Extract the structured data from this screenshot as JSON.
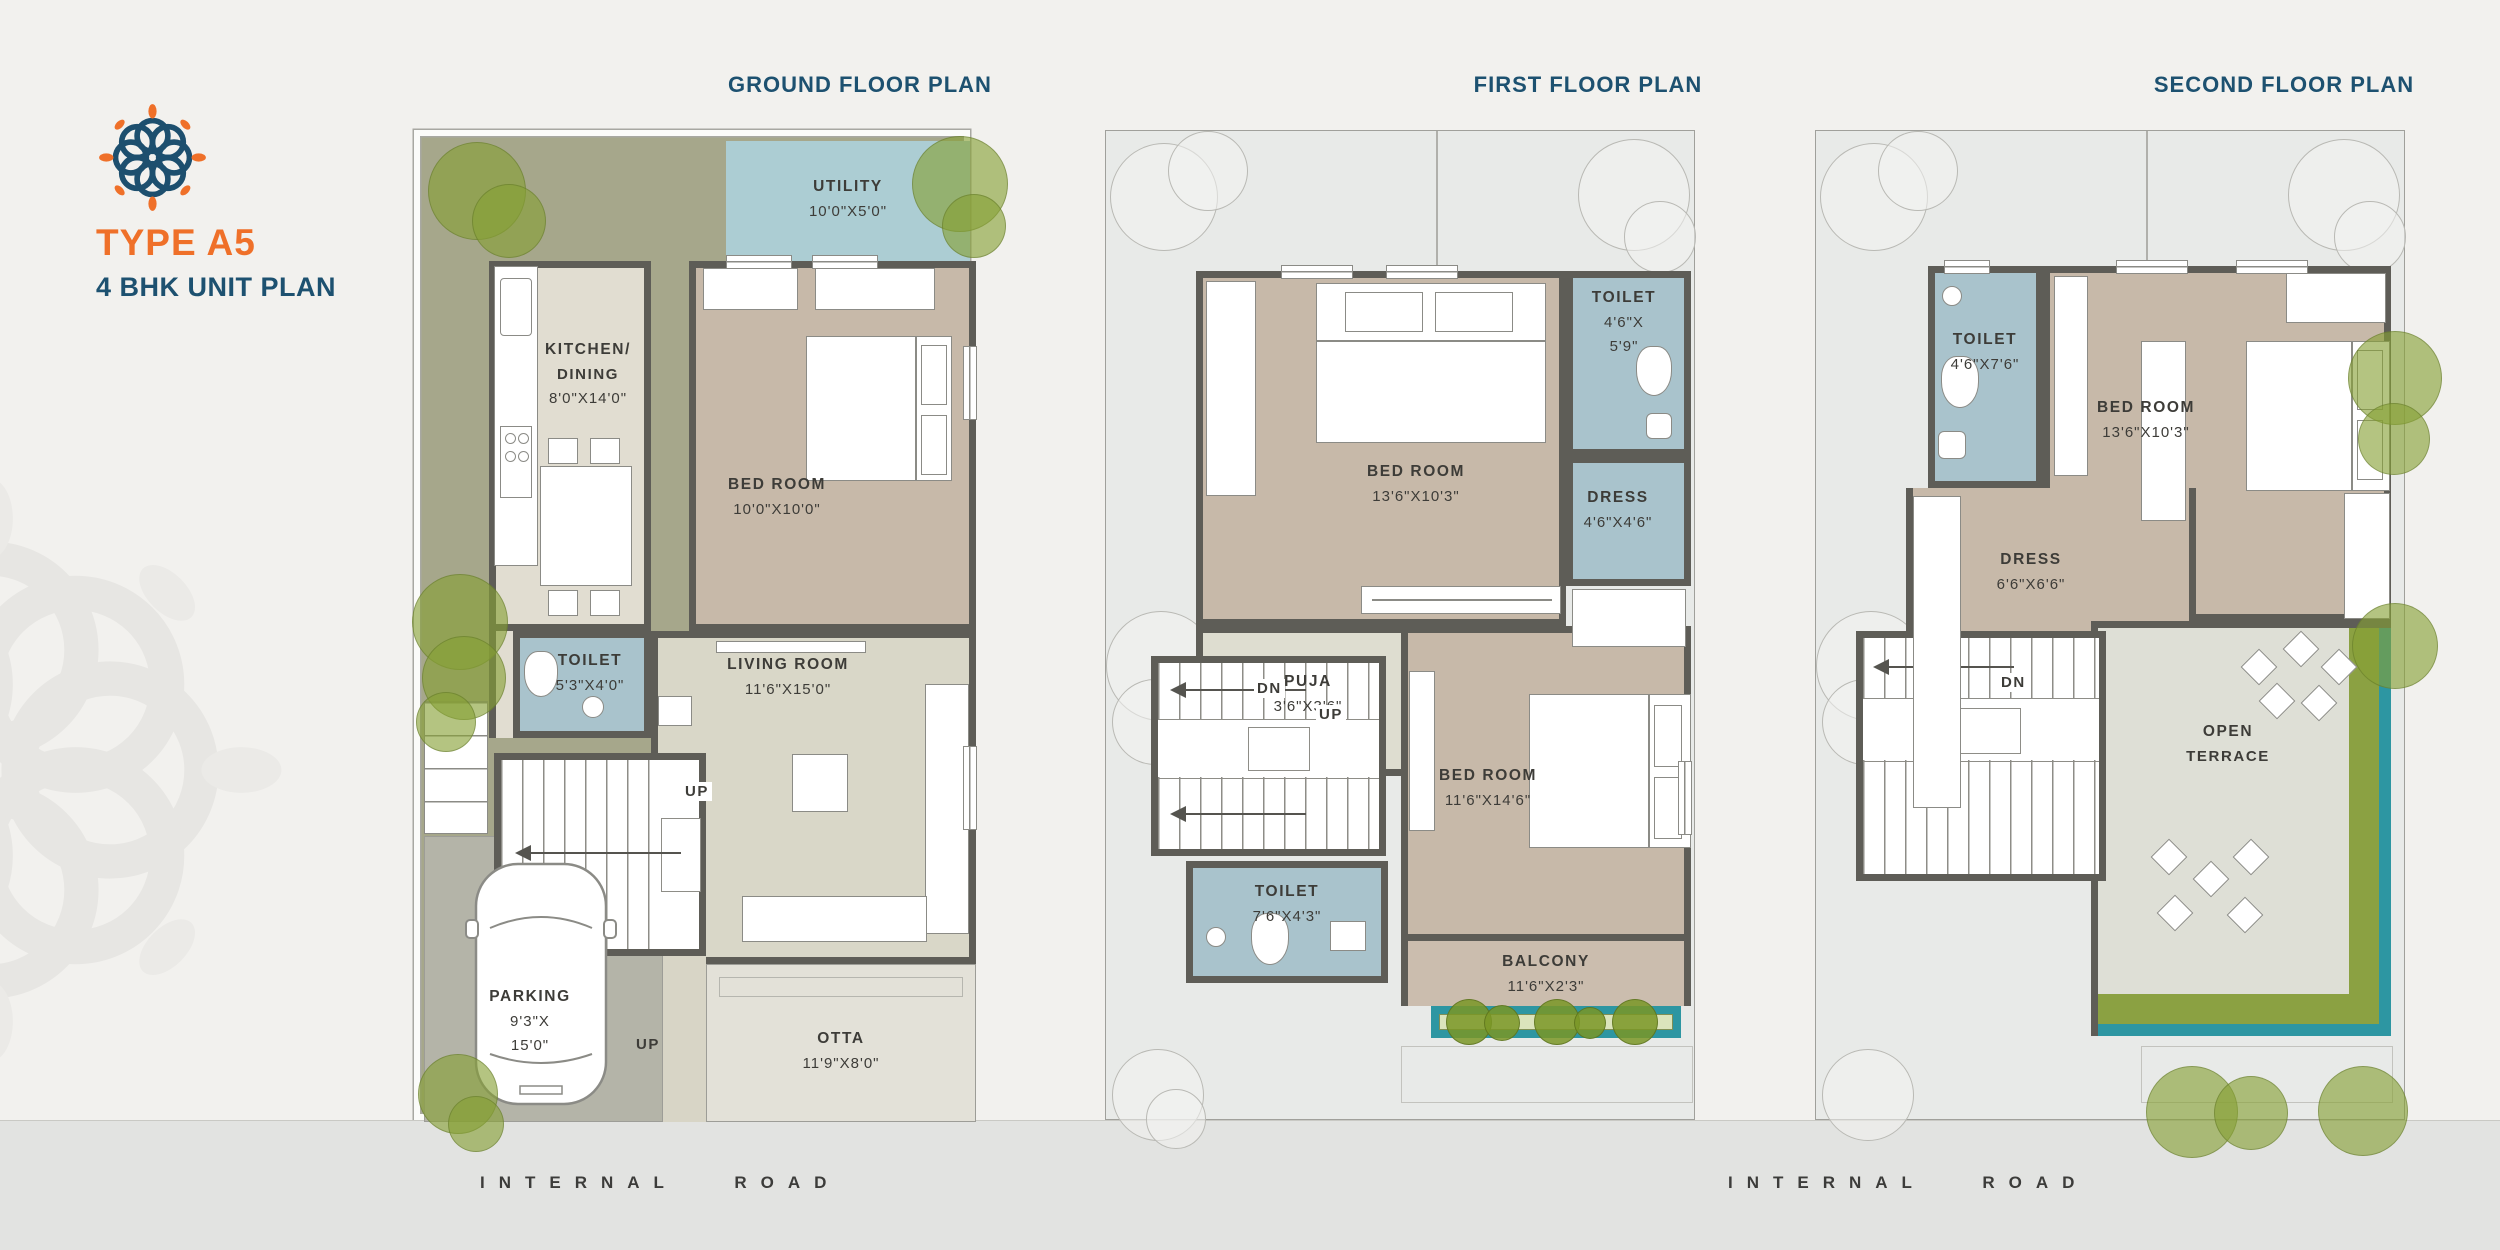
{
  "page": {
    "road_label_left": "INTERNAL ROAD",
    "road_label_right": "INTERNAL ROAD"
  },
  "brand": {
    "type_label": "TYPE A5",
    "unit_label": "4 BHK UNIT PLAN",
    "accent_orange": "#ef7029",
    "accent_navy": "#1d5170"
  },
  "colors": {
    "wall": "#5e5d57",
    "garden_olive": "#a6a78b",
    "toilet_blue": "#a9c3cc",
    "utility_blue": "#accdd3",
    "bedroom_tan": "#c7b9a9",
    "terrace_green": "#8ba142",
    "terrace_teal": "#2d96a2",
    "plot_gray": "#e8eae8"
  },
  "plans": {
    "ground": {
      "title": "GROUND FLOOR PLAN",
      "rooms": {
        "utility": {
          "name": "UTILITY",
          "dims": "10'0\"X5'0\""
        },
        "kitchen": {
          "line1": "KITCHEN/",
          "line2": "DINING",
          "dims": "8'0\"X14'0\""
        },
        "bedroom": {
          "name": "BED ROOM",
          "dims": "10'0\"X10'0\""
        },
        "living": {
          "name": "LIVING ROOM",
          "dims": "11'6\"X15'0\""
        },
        "toilet": {
          "name": "TOILET",
          "dims": "5'3\"X4'0\""
        },
        "parking": {
          "name": "PARKING",
          "dims1": "9'3\"X",
          "dims2": "15'0\""
        },
        "otta": {
          "name": "OTTA",
          "dims": "11'9\"X8'0\""
        }
      },
      "stair_up": "UP",
      "drive_up": "UP"
    },
    "first": {
      "title": "FIRST FLOOR PLAN",
      "rooms": {
        "bedroom1": {
          "name": "BED ROOM",
          "dims": "13'6\"X10'3\""
        },
        "toilet1": {
          "name": "TOILET",
          "dims1": "4'6\"X",
          "dims2": "5'9\""
        },
        "dress1": {
          "name": "DRESS",
          "dims": "4'6\"X4'6\""
        },
        "puja": {
          "name": "PUJA",
          "dims": "3'6\"X3'6\""
        },
        "bedroom2": {
          "name": "BED ROOM",
          "dims": "11'6\"X14'6\""
        },
        "toilet2": {
          "name": "TOILET",
          "dims": "7'6\"X4'3\""
        },
        "balcony": {
          "name": "BALCONY",
          "dims": "11'6\"X2'3\""
        }
      },
      "stair_dn": "DN",
      "stair_up": "UP"
    },
    "second": {
      "title": "SECOND FLOOR PLAN",
      "rooms": {
        "toilet": {
          "name": "TOILET",
          "dims": "4'6\"X7'6\""
        },
        "bedroom": {
          "name": "BED ROOM",
          "dims": "13'6\"X10'3\""
        },
        "dress": {
          "name": "DRESS",
          "dims": "6'6\"X6'6\""
        },
        "terrace": {
          "line1": "OPEN",
          "line2": "TERRACE"
        }
      },
      "stair_dn": "DN"
    }
  }
}
